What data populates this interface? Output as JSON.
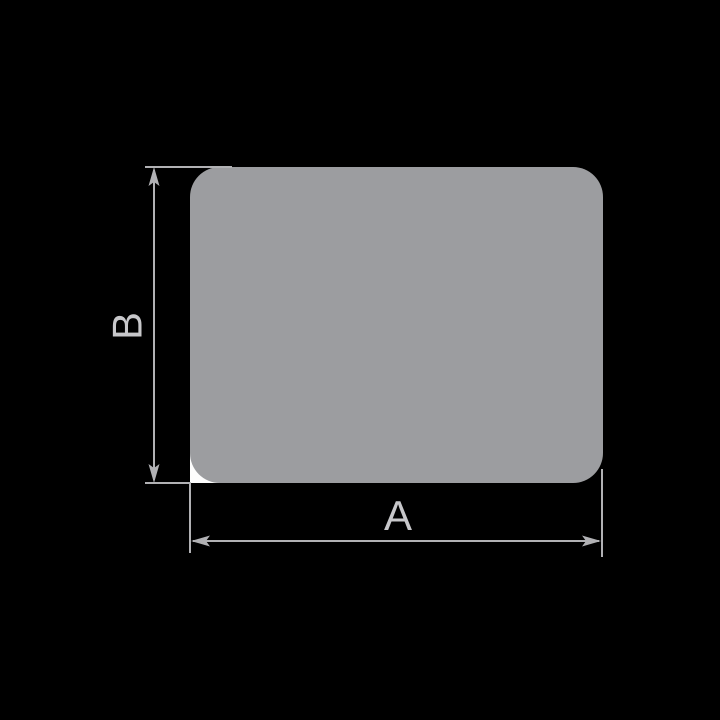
{
  "diagram": {
    "labels": {
      "width": "A",
      "height": "B"
    },
    "colors": {
      "background": "#000000",
      "shape_fill": "#9c9da0",
      "dimension_line": "#b1b1b4",
      "label_text": "#c7c7ca",
      "corner_pocket": "#fdfdfd"
    }
  }
}
